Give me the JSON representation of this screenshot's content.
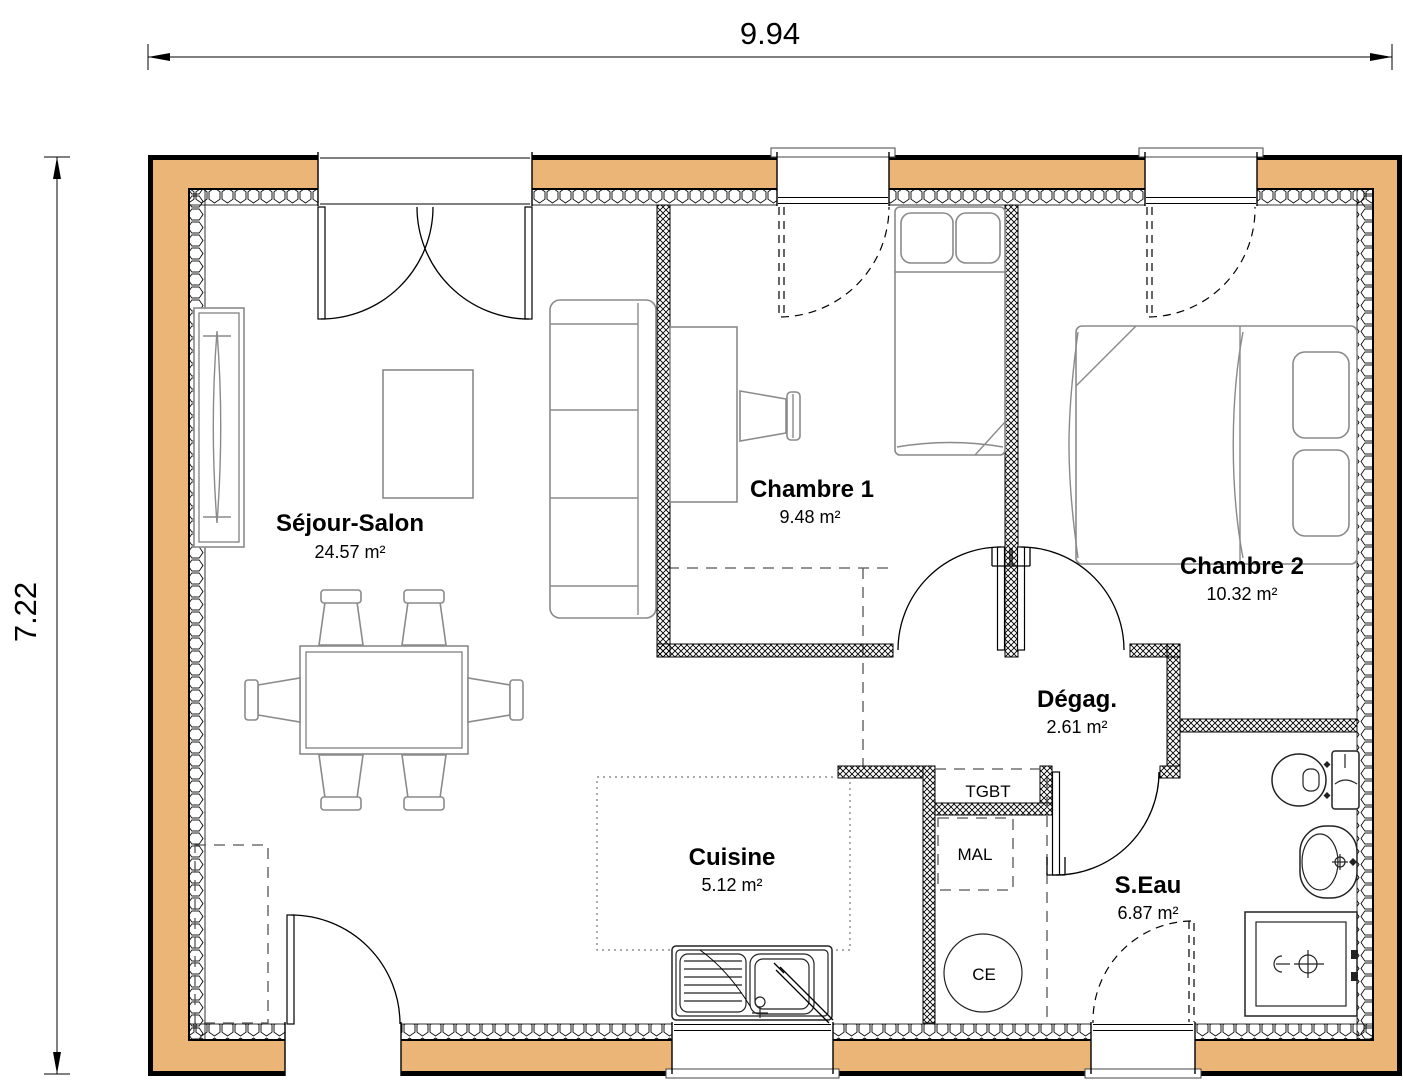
{
  "dimensions": {
    "width_label": "9.94",
    "height_label": "7.22"
  },
  "rooms": {
    "sejour": {
      "name": "Séjour-Salon",
      "area": "24.57 m²"
    },
    "chambre1": {
      "name": "Chambre 1",
      "area": "9.48 m²"
    },
    "chambre2": {
      "name": "Chambre 2",
      "area": "10.32 m²"
    },
    "degagement": {
      "name": "Dégag.",
      "area": "2.61 m²"
    },
    "cuisine": {
      "name": "Cuisine",
      "area": "5.12 m²"
    },
    "salle_eau": {
      "name": "S.Eau",
      "area": "6.87 m²"
    }
  },
  "equipment": {
    "electrical_panel": "TGBT",
    "washing_machine": "MAL",
    "water_heater": "CE"
  },
  "colors": {
    "wall": "#ecb578",
    "line": "#000000",
    "furniture": "#8a8a8a"
  }
}
